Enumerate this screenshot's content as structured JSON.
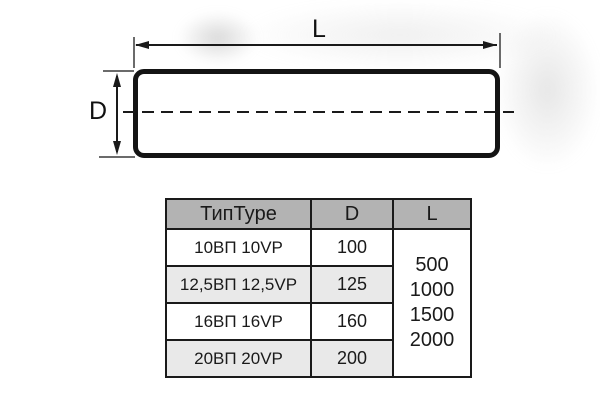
{
  "diagram": {
    "length_label": "L",
    "diameter_label": "D",
    "line_color": "#1a1a1a"
  },
  "table": {
    "col_headers": [
      "ТипType",
      "D",
      "L"
    ],
    "rows": [
      {
        "type": "10ВП 10VP",
        "d": "100"
      },
      {
        "type": "12,5ВП 12,5VP",
        "d": "125"
      },
      {
        "type": "16ВП 16VP",
        "d": "160"
      },
      {
        "type": "20ВП 20VP",
        "d": "200"
      }
    ],
    "l_values": [
      "500",
      "1000",
      "1500",
      "2000"
    ],
    "colors": {
      "header_bg": "#b3b3b3",
      "alt_row_bg": "#e9e9e9",
      "border": "#1a1a1a",
      "text": "#1a1a1a"
    }
  }
}
